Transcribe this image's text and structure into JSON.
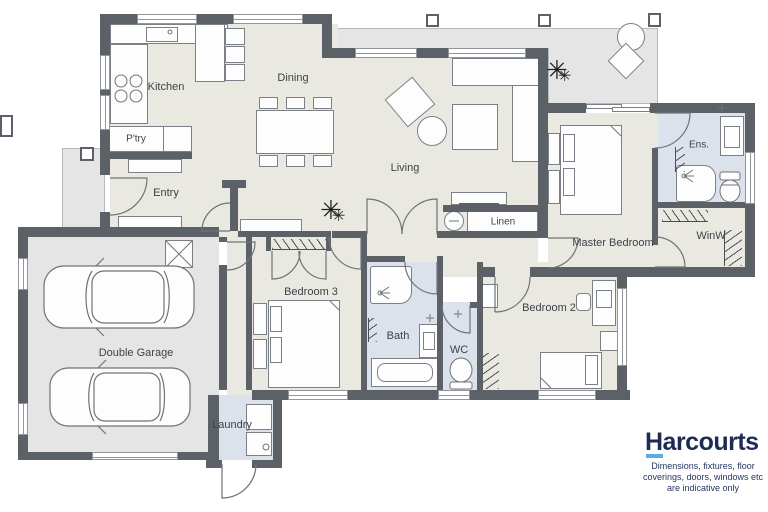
{
  "rooms": [
    {
      "label": "Kitchen"
    },
    {
      "label": "Dining"
    },
    {
      "label": "P'try"
    },
    {
      "label": "Entry"
    },
    {
      "label": "Living"
    },
    {
      "label": "Linen"
    },
    {
      "label": "Master Bedroom"
    },
    {
      "label": "Ens."
    },
    {
      "label": "WinW"
    },
    {
      "label": "Bedroom 3"
    },
    {
      "label": "Bath"
    },
    {
      "label": "WC"
    },
    {
      "label": "Bedroom 2"
    },
    {
      "label": "Double Garage"
    },
    {
      "label": "Laundry"
    }
  ],
  "brand": {
    "name": "Harcourts",
    "disclaimer": [
      "Dimensions, fixtures, floor",
      "coverings, doors, windows etc",
      "are indicative only"
    ]
  },
  "colors": {
    "wall": "#5c6167",
    "floor_main": "#e9e9e1",
    "floor_wet": "#dbe2ec",
    "floor_hard": "#e4e5e4",
    "brand_navy": "#1d2b55",
    "brand_blue": "#58aee0"
  },
  "icons": {
    "plant": "plant-icon",
    "car": "car-icon",
    "bed": "bed-icon",
    "toilet": "toilet-icon",
    "shower": "shower-icon"
  }
}
